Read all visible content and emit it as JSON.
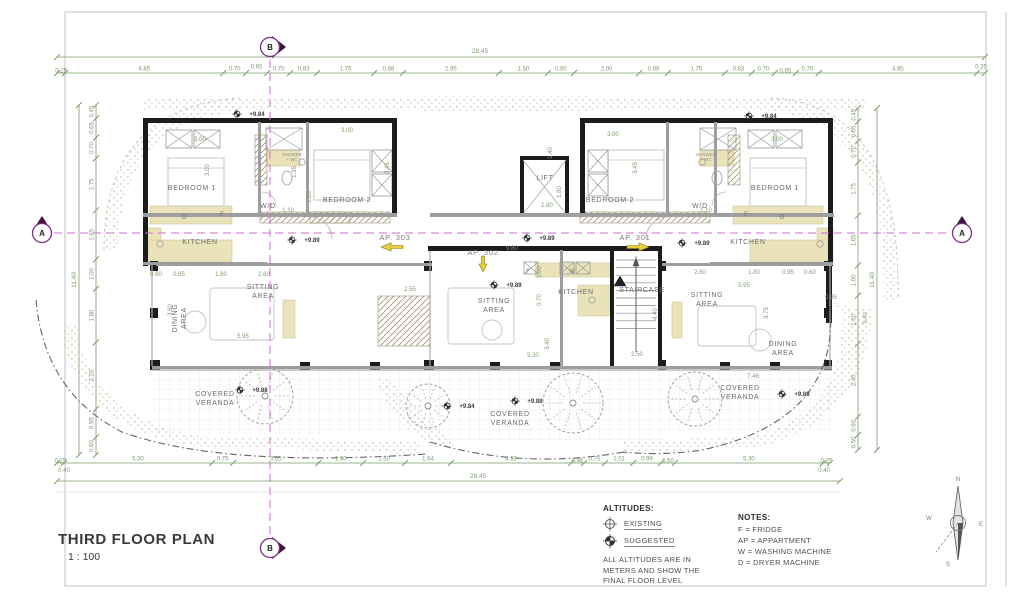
{
  "title_block": {
    "title": "THIRD FLOOR PLAN",
    "scale": "1 : 100"
  },
  "altitudes_legend": {
    "heading": "ALTITUDES:",
    "existing": "EXISTING",
    "suggested": "SUGGESTED",
    "note_lines": [
      "ALL ALTITUDES ARE IN",
      "METERS AND SHOW THE",
      "FINAL FLOOR LEVEL"
    ]
  },
  "notes": {
    "heading": "NOTES:",
    "items": [
      "F = FRIDGE",
      "AP = APPARTMENT",
      "W = WASHING MACHINE",
      "D = DRYER MACHINE"
    ]
  },
  "compass": {
    "n": "N",
    "e": "E",
    "s": "S",
    "w": "W"
  },
  "grid_markers": [
    {
      "label": "A",
      "x": 42,
      "y": 233,
      "dir": "up"
    },
    {
      "label": "A",
      "x": 962,
      "y": 233,
      "dir": "up"
    },
    {
      "label": "B",
      "x": 270,
      "y": 47,
      "dir": "right"
    },
    {
      "label": "B",
      "x": 270,
      "y": 548,
      "dir": "right"
    }
  ],
  "apartment_labels": [
    {
      "label": "AP. 303",
      "x": 395,
      "y": 240,
      "arrow": "left"
    },
    {
      "label": "AP. 302",
      "x": 483,
      "y": 255,
      "arrow": "down"
    },
    {
      "label": "AP. 301",
      "x": 635,
      "y": 240,
      "arrow": "right"
    }
  ],
  "room_labels": [
    {
      "lines": [
        "BEDROOM 1"
      ],
      "x": 192,
      "y": 190
    },
    {
      "lines": [
        "BEDROOM 2"
      ],
      "x": 347,
      "y": 202
    },
    {
      "lines": [
        "W/D"
      ],
      "x": 268,
      "y": 208
    },
    {
      "lines": [
        "KITCHEN"
      ],
      "x": 200,
      "y": 244
    },
    {
      "lines": [
        "SITTING",
        "AREA"
      ],
      "x": 263,
      "y": 289
    },
    {
      "lines": [
        "DINING",
        "AREA"
      ],
      "x": 177,
      "y": 318,
      "rot": -90
    },
    {
      "lines": [
        "COVERED",
        "VERANDA"
      ],
      "x": 215,
      "y": 396
    },
    {
      "lines": [
        "LIFT"
      ],
      "x": 545,
      "y": 180
    },
    {
      "lines": [
        "SITTING",
        "AREA"
      ],
      "x": 494,
      "y": 303
    },
    {
      "lines": [
        "KITCHEN"
      ],
      "x": 576,
      "y": 294
    },
    {
      "lines": [
        "STAIRCASE"
      ],
      "x": 642,
      "y": 292
    },
    {
      "lines": [
        "COVERED",
        "VERANDA"
      ],
      "x": 510,
      "y": 416
    },
    {
      "lines": [
        "BEDROOM 2"
      ],
      "x": 610,
      "y": 202
    },
    {
      "lines": [
        "BEDROOM 1"
      ],
      "x": 775,
      "y": 190
    },
    {
      "lines": [
        "W/D"
      ],
      "x": 700,
      "y": 208
    },
    {
      "lines": [
        "KITCHEN"
      ],
      "x": 748,
      "y": 244
    },
    {
      "lines": [
        "SITTING",
        "AREA"
      ],
      "x": 707,
      "y": 297
    },
    {
      "lines": [
        "DINING",
        "AREA"
      ],
      "x": 783,
      "y": 346
    },
    {
      "lines": [
        "COVERED",
        "VERANDA"
      ],
      "x": 740,
      "y": 390
    }
  ],
  "micro_labels": [
    {
      "lines": [
        "SHOWER",
        "+ WC"
      ],
      "x": 292,
      "y": 156
    },
    {
      "lines": [
        "SHOWER",
        "+ WC"
      ],
      "x": 706,
      "y": 156
    }
  ],
  "appliance_labels": [
    {
      "t": "D",
      "x": 184,
      "y": 219
    },
    {
      "t": "F",
      "x": 222,
      "y": 216
    },
    {
      "t": "F",
      "x": 746,
      "y": 216
    },
    {
      "t": "D",
      "x": 782,
      "y": 219
    },
    {
      "t": "F",
      "x": 528,
      "y": 273
    },
    {
      "t": "W",
      "x": 572,
      "y": 273
    }
  ],
  "altitude_markers": [
    {
      "value": "+9.84",
      "x": 245,
      "y": 116
    },
    {
      "value": "+9.84",
      "x": 757,
      "y": 118
    },
    {
      "value": "+9.89",
      "x": 300,
      "y": 242
    },
    {
      "value": "+9.89",
      "x": 535,
      "y": 240
    },
    {
      "value": "+9.89",
      "x": 502,
      "y": 287
    },
    {
      "value": "+9.89",
      "x": 690,
      "y": 245
    },
    {
      "value": "+9.88",
      "x": 248,
      "y": 392
    },
    {
      "value": "+9.88",
      "x": 523,
      "y": 403
    },
    {
      "value": "+9.84",
      "x": 455,
      "y": 408
    },
    {
      "value": "+9.88",
      "x": 790,
      "y": 396
    }
  ],
  "dimensions": {
    "top": {
      "total": "28.45",
      "segments": [
        "0.25",
        "4.85",
        "0.70",
        "0.65",
        "0.70",
        "0.83",
        "1.75",
        "0.88",
        "2.95",
        "1.50",
        "0.80",
        "2.00",
        "0.88",
        "1.75",
        "0.83",
        "0.70",
        "0.65",
        "0.70",
        "4.85",
        "0.25"
      ]
    },
    "bottom": {
      "total": "28.45",
      "segments": [
        "0.25",
        "5.30",
        "0.75",
        "3.05",
        "1.60",
        "1.50",
        "1.64",
        "4.30",
        "0.46",
        "0.75",
        "1.01",
        "0.99",
        "0.50",
        "5.30",
        "0.25"
      ],
      "end_extras": [
        "0.40",
        "0.40"
      ]
    },
    "left": {
      "total": "11.40",
      "segments": [
        "0.45",
        "0.65",
        "0.70",
        "1.75",
        "1.65",
        "1.00",
        "1.80",
        "2.25",
        "0.95",
        "0.60"
      ]
    },
    "right": {
      "total": "11.40",
      "segments": [
        "0.45",
        "0.65",
        "0.70",
        "1.75",
        "1.65",
        "1.00",
        "1.60",
        "2.40",
        "0.60",
        "0.50"
      ]
    },
    "inplan": [
      {
        "t": "3.00",
        "x": 200,
        "y": 141
      },
      {
        "t": "3.00",
        "x": 347,
        "y": 132
      },
      {
        "t": "3.00",
        "x": 613,
        "y": 136
      },
      {
        "t": "3.00",
        "x": 777,
        "y": 141
      },
      {
        "t": "3.45",
        "x": 389,
        "y": 168,
        "v": true
      },
      {
        "t": "3.45",
        "x": 637,
        "y": 168,
        "v": true
      },
      {
        "t": "3.00",
        "x": 209,
        "y": 170,
        "v": true
      },
      {
        "t": "1.35",
        "x": 296,
        "y": 172,
        "v": true
      },
      {
        "t": "1.00",
        "x": 311,
        "y": 197,
        "v": true
      },
      {
        "t": "1.10",
        "x": 288,
        "y": 212
      },
      {
        "t": "1.10",
        "x": 706,
        "y": 212
      },
      {
        "t": "1.40",
        "x": 552,
        "y": 153,
        "v": true
      },
      {
        "t": "1.80",
        "x": 561,
        "y": 192,
        "v": true
      },
      {
        "t": "1.80",
        "x": 547,
        "y": 207
      },
      {
        "t": "9.80",
        "x": 512,
        "y": 250
      },
      {
        "t": "2.55",
        "x": 410,
        "y": 291
      },
      {
        "t": "1.00",
        "x": 541,
        "y": 272,
        "v": true
      },
      {
        "t": "0.70",
        "x": 541,
        "y": 300,
        "v": true
      },
      {
        "t": "5.30",
        "x": 533,
        "y": 357
      },
      {
        "t": "3.40",
        "x": 549,
        "y": 344,
        "v": true
      },
      {
        "t": "2.50",
        "x": 637,
        "y": 356
      },
      {
        "t": "4.40",
        "x": 657,
        "y": 314,
        "v": true
      },
      {
        "t": "5.95",
        "x": 243,
        "y": 338
      },
      {
        "t": "3.60",
        "x": 172,
        "y": 310,
        "v": true
      },
      {
        "t": "0.60",
        "x": 156,
        "y": 276
      },
      {
        "t": "0.95",
        "x": 179,
        "y": 276
      },
      {
        "t": "1.80",
        "x": 221,
        "y": 276
      },
      {
        "t": "2.60",
        "x": 264,
        "y": 276
      },
      {
        "t": "5.95",
        "x": 744,
        "y": 287
      },
      {
        "t": "2.60",
        "x": 700,
        "y": 274
      },
      {
        "t": "1.80",
        "x": 754,
        "y": 274
      },
      {
        "t": "0.95",
        "x": 788,
        "y": 274
      },
      {
        "t": "0.60",
        "x": 810,
        "y": 274
      },
      {
        "t": "3.75",
        "x": 768,
        "y": 313,
        "v": true
      },
      {
        "t": "7.46",
        "x": 753,
        "y": 378
      },
      {
        "t": "0.95",
        "x": 831,
        "y": 299
      },
      {
        "t": "3.40",
        "x": 867,
        "y": 318,
        "v": true
      }
    ]
  },
  "colors": {
    "dimension": "#7d9b6d",
    "axis": "#cf6bcf",
    "bubble_stroke": "#7b2e86",
    "bubble_fill": "#3f0f3f",
    "wall": "#1c1c1c",
    "accent_yellow": "#e8ce3f",
    "beige": "#eae3b9",
    "label_gray": "#6b6b6b"
  }
}
